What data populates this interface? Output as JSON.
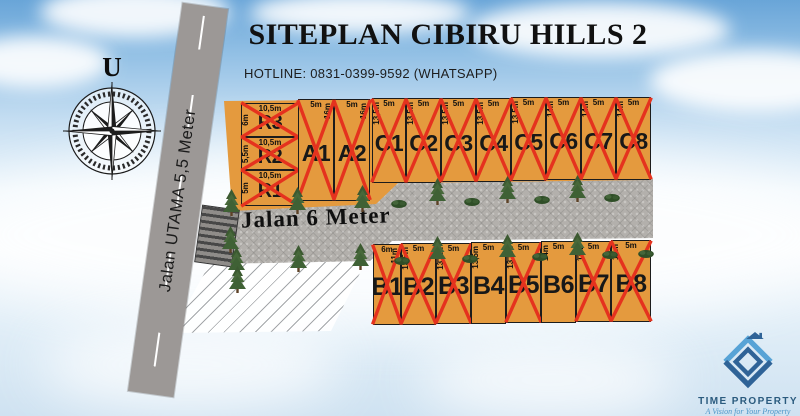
{
  "title": "SITEPLAN CIBIRU HILLS 2",
  "hotline": "HOTLINE: 0831-0399-9592 (WHATSAPP)",
  "compass": {
    "north_label": "U"
  },
  "roads": {
    "utama_label": "Jalan UTAMA 5,5 Meter",
    "internal_label": "Jalan 6 Meter"
  },
  "colors": {
    "lot-fill": "#E49A3E",
    "lot-border": "#1C1C1C",
    "sold-mark": "#E5321E",
    "road-fill": "#B3B0AC",
    "road-utama": "#9C9896",
    "logo-dark": "#2F6397",
    "logo-light": "#57A3D6"
  },
  "lots": [
    {
      "name": "R3",
      "top": "10,5m",
      "side": "6m",
      "sold": true,
      "rect": [
        241,
        103,
        58,
        34
      ]
    },
    {
      "name": "R2",
      "top": "10,5m",
      "side": "5,5m",
      "sold": true,
      "rect": [
        241,
        137,
        58,
        33
      ]
    },
    {
      "name": "R1",
      "top": "10,5m",
      "side": "5m",
      "sold": true,
      "rect": [
        241,
        170,
        58,
        36
      ]
    },
    {
      "name": "A1",
      "top": "5m",
      "side": "16m",
      "sold": true,
      "rect": [
        298,
        99,
        36,
        102
      ]
    },
    {
      "name": "A2",
      "top": "5m",
      "side": "16m",
      "sold": true,
      "rect": [
        334,
        99,
        36,
        102
      ]
    },
    {
      "name": "C1",
      "top": "5m",
      "side": "13,5m",
      "sold": true,
      "rect": [
        372,
        98,
        34,
        85
      ]
    },
    {
      "name": "C2",
      "top": "5m",
      "side": "13,5m",
      "sold": true,
      "rect": [
        406,
        98,
        35,
        85
      ]
    },
    {
      "name": "C3",
      "top": "5m",
      "side": "13,5m",
      "sold": true,
      "rect": [
        441,
        98,
        35,
        84
      ]
    },
    {
      "name": "C4",
      "top": "5m",
      "side": "13,5m",
      "sold": true,
      "rect": [
        476,
        98,
        35,
        84
      ]
    },
    {
      "name": "C5",
      "top": "5m",
      "side": "13,5m",
      "sold": true,
      "rect": [
        511,
        97,
        35,
        84
      ]
    },
    {
      "name": "C6",
      "top": "5m",
      "side": "14m",
      "sold": true,
      "rect": [
        546,
        97,
        35,
        83
      ]
    },
    {
      "name": "C7",
      "top": "5m",
      "side": "14m",
      "sold": true,
      "rect": [
        581,
        97,
        35,
        83
      ]
    },
    {
      "name": "C8",
      "top": "5m",
      "side": "14m",
      "sold": true,
      "rect": [
        616,
        97,
        35,
        83
      ]
    },
    {
      "name": "B1",
      "top": "6m",
      "side": "11m",
      "sold": true,
      "rect": [
        373,
        244,
        28,
        81
      ]
    },
    {
      "name": "B2",
      "top": "5m",
      "side": "13,5m",
      "sold": true,
      "rect": [
        401,
        243,
        35,
        82
      ]
    },
    {
      "name": "B3",
      "top": "5m",
      "side": "13,5m",
      "sold": true,
      "rect": [
        436,
        243,
        35,
        81
      ]
    },
    {
      "name": "B4",
      "top": "5m",
      "side": "13,5m",
      "sold": false,
      "rect": [
        471,
        242,
        35,
        82
      ]
    },
    {
      "name": "B5",
      "top": "5m",
      "side": "13,5m",
      "sold": true,
      "rect": [
        506,
        242,
        35,
        81
      ]
    },
    {
      "name": "B6",
      "top": "5m",
      "side": "14m",
      "sold": false,
      "rect": [
        541,
        241,
        35,
        82
      ]
    },
    {
      "name": "B7",
      "top": "5m",
      "side": "14m",
      "sold": true,
      "rect": [
        576,
        241,
        35,
        81
      ]
    },
    {
      "name": "B8",
      "top": "5m",
      "side": "14m",
      "sold": true,
      "rect": [
        611,
        240,
        40,
        82
      ]
    }
  ],
  "logo": {
    "brand": "TIME PROPERTY",
    "tagline": "A Vision for Your Property"
  }
}
